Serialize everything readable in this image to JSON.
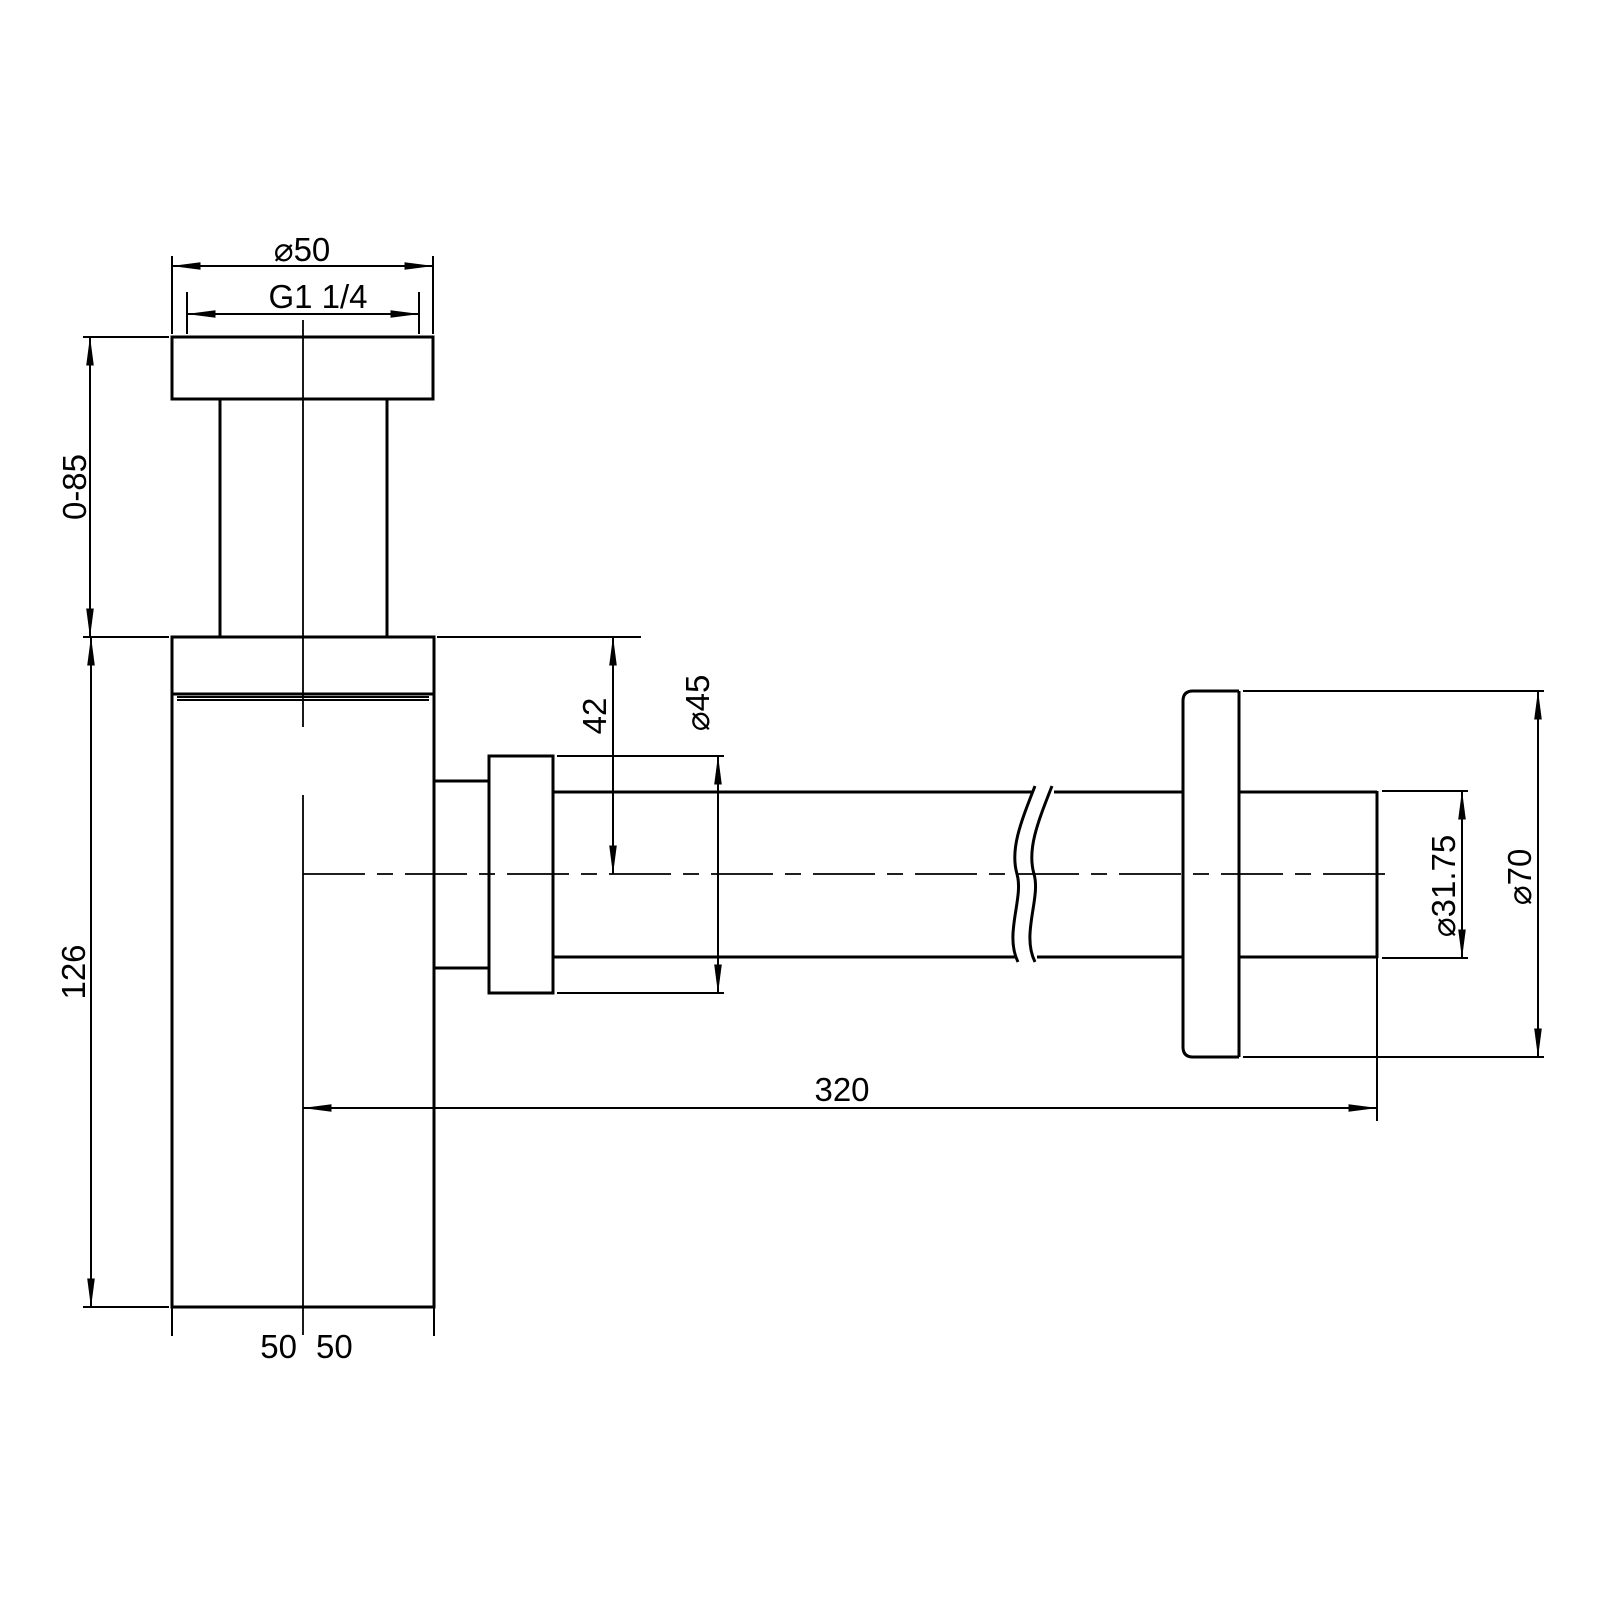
{
  "drawing": {
    "dimension_labels": {
      "top_flange_diameter": "⌀50",
      "thread_size": "G1 1/4",
      "tail_pipe_height": "0-85",
      "body_height": "126",
      "outlet_drop": "42",
      "outlet_nut_diameter": "⌀45",
      "wall_pipe_diameter": "⌀31.75",
      "wall_flange_diameter": "⌀70",
      "horizontal_reach": "320",
      "base_offset_left": "50",
      "base_offset_right": "50"
    }
  }
}
